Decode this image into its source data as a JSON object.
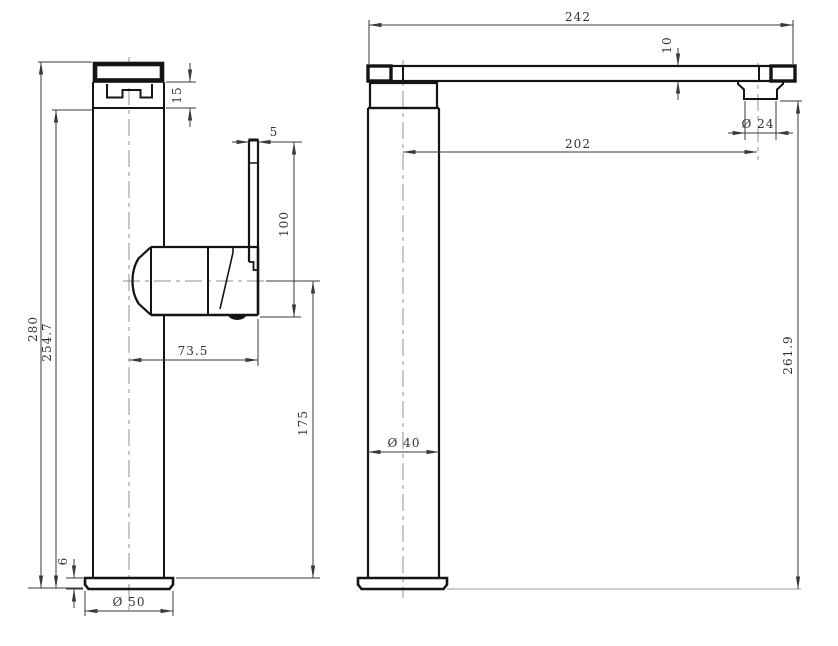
{
  "drawing": {
    "subject": "Tall single-lever basin mixer tap - two-view dimensioned technical drawing",
    "views": {
      "side": "side view",
      "front": "front view"
    },
    "colors": {
      "object_line": "#141414",
      "dimension_line": "#3a3a3a",
      "centerline": "#8f8f8f",
      "background": "#ffffff"
    }
  },
  "side_view": {
    "dims": {
      "overall_height": "280",
      "spout_height": "254.7",
      "cap_height": "15",
      "lever_thickness": "5",
      "lever_length": "100",
      "handle_reach": "73.5",
      "body_center_height": "175",
      "base_thickness": "6",
      "base_diameter": "Ø 50"
    }
  },
  "front_view": {
    "dims": {
      "overall_width": "242",
      "spout_bar_thickness": "10",
      "spout_reach": "202",
      "outlet_diameter": "Ø 24",
      "column_diameter": "Ø 40",
      "outlet_height": "261.9"
    }
  }
}
